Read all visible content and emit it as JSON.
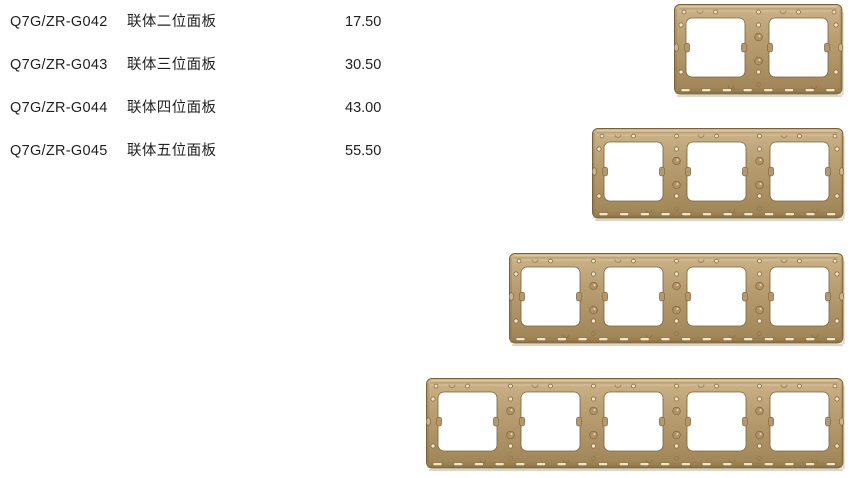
{
  "page": {
    "background": "#ffffff",
    "text_color": "#1f1f1f"
  },
  "products": [
    {
      "code": "Q7G/ZR-G042",
      "name": "联体二位面板",
      "price": "17.50",
      "gangs": 2
    },
    {
      "code": "Q7G/ZR-G043",
      "name": "联体三位面板",
      "price": "30.50",
      "gangs": 3
    },
    {
      "code": "Q7G/ZR-G044",
      "name": "联体四位面板",
      "price": "43.00",
      "gangs": 4
    },
    {
      "code": "Q7G/ZR-G045",
      "name": "联体五位面板",
      "price": "55.50",
      "gangs": 5
    }
  ],
  "panel_style": {
    "gold_light": "#cdb58a",
    "gold_mid": "#b89e71",
    "gold_dark": "#9e8455",
    "edge_dark": "#7a6138",
    "bottom_edge": "#8d7449",
    "hole_light": "#f2e5c6",
    "boss_fill": "#b09468",
    "tab_fill": "#b39970",
    "opening_fill": "#ffffff",
    "shadow": "#ddd6c6"
  }
}
